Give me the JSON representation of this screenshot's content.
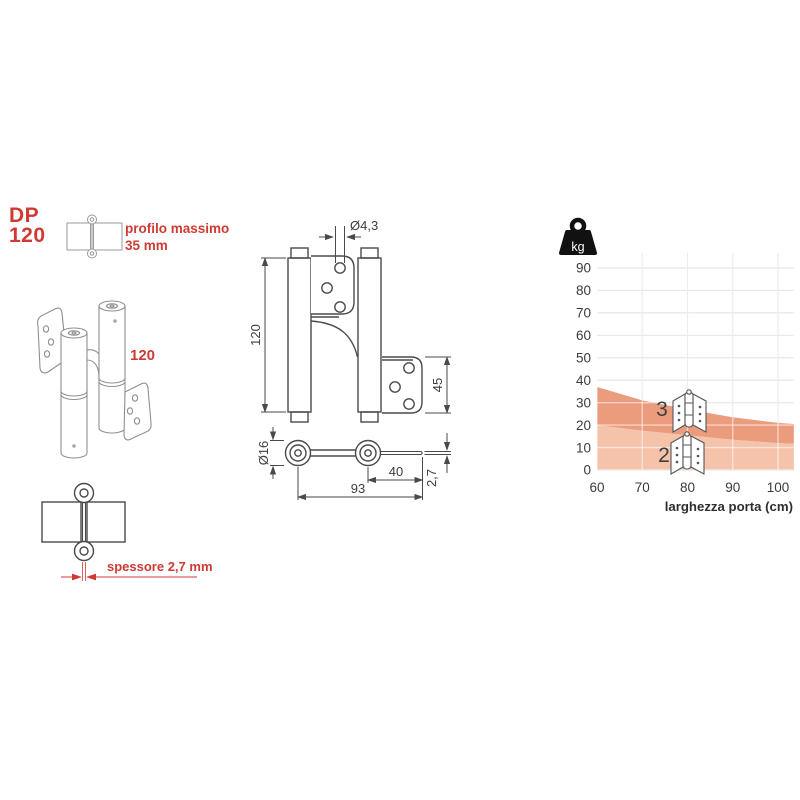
{
  "colors": {
    "accent_red": "#cf3b33",
    "drawing_line": "#4a4a4a",
    "iso_line": "#8f8f8f",
    "grid": "#e8e8e8",
    "band_3_hinges": "#eb9c7d",
    "band_2_hinges": "#f4c3a9",
    "text_dark": "#3d3d3d"
  },
  "header": {
    "model": "DP",
    "size": "120",
    "profile_note_1": "profilo massimo",
    "profile_note_2": "35 mm"
  },
  "iso_view": {
    "height_label": "120"
  },
  "top_view_detail": {
    "thickness_label": "spessore 2,7 mm"
  },
  "front_view_dims": {
    "hole_diameter": "Ø4,3",
    "height": "120",
    "plate_height": "45"
  },
  "plan_view_dims": {
    "knuckle_diameter": "Ø16",
    "offset": "40",
    "length": "93",
    "thickness": "2,7"
  },
  "chart_data": {
    "type": "area",
    "title": "",
    "xlabel": "larghezza porta (cm)",
    "ylabel": "kg",
    "xlim": [
      60,
      103.5
    ],
    "ylim": [
      0,
      90
    ],
    "xticks": [
      60,
      70,
      80,
      90,
      100
    ],
    "yticks": [
      0,
      10,
      20,
      30,
      40,
      50,
      60,
      70,
      80,
      90
    ],
    "grid": true,
    "x": [
      60,
      70,
      80,
      90,
      100,
      103.5
    ],
    "series": [
      {
        "name": "max door weight with 3 hinges (kg)",
        "values": [
          37,
          31,
          27,
          23.5,
          21,
          20.5
        ],
        "fill": "#eb9c7d"
      },
      {
        "name": "max door weight with 2 hinges (kg)",
        "values": [
          20,
          17.5,
          15.5,
          13.5,
          12,
          11.7
        ],
        "fill": "#f4c3a9"
      }
    ],
    "annotations": [
      "3",
      "2"
    ],
    "legend": "hinge-count icons drawn inside plot"
  }
}
